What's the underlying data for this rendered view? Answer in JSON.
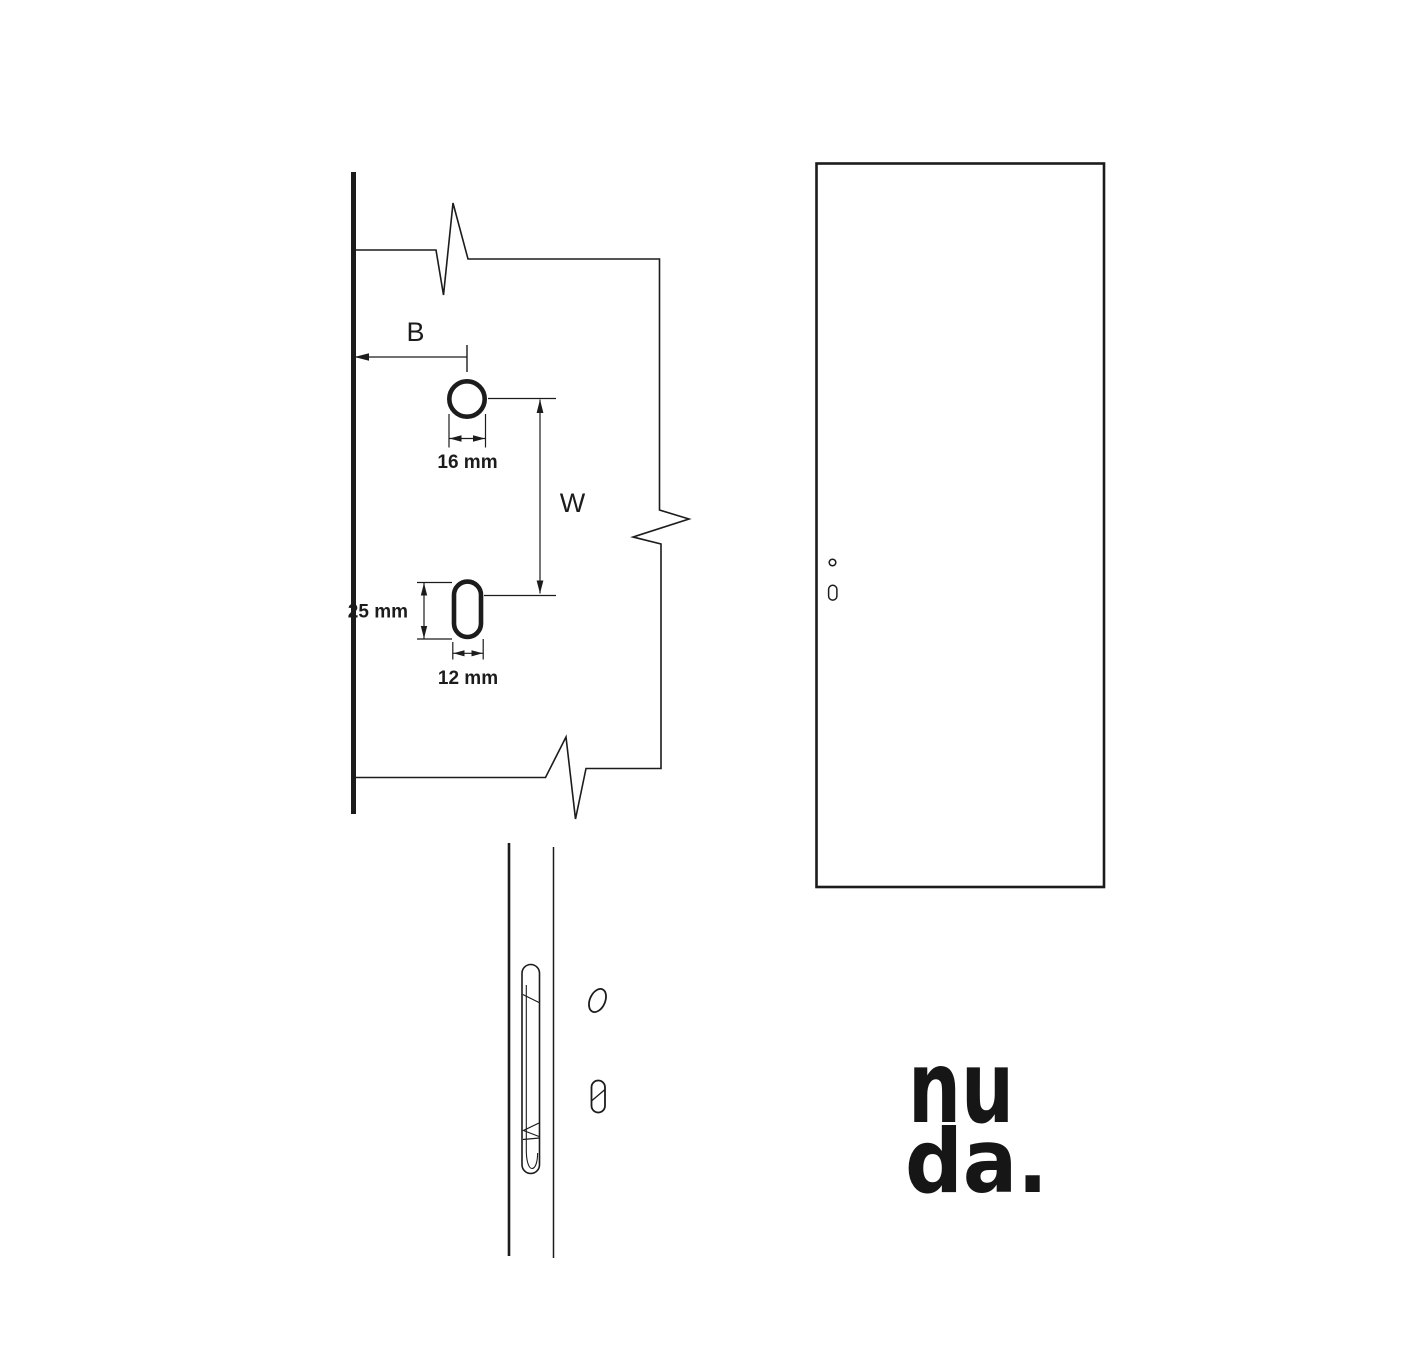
{
  "colors": {
    "background": "#ffffff",
    "ink": "#1c1c1c"
  },
  "drilling_template": {
    "border_distance_label": "B",
    "height_distance_label": "W",
    "round_hole_diameter": "16 mm",
    "oblong_slot_height": "25 mm",
    "oblong_slot_width": "12 mm"
  },
  "brand_logo": {
    "line1": "nu",
    "line2": "da."
  }
}
